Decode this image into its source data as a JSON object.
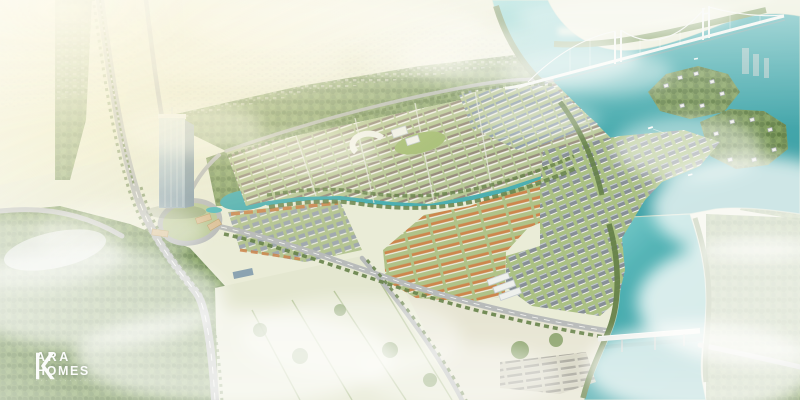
{
  "meta": {
    "title": "Aerial 3D master-plan rendering of a riverside township",
    "width": 800,
    "height": 400
  },
  "watermark": {
    "monogram": "K",
    "name_top": "ARA",
    "name_bottom": "HOMES",
    "tagline": "· · · · · · · · · · · · · ·"
  },
  "palette": {
    "land": "#e9ebd6",
    "field": "#e3e6cf",
    "lawn": "#b2c38f",
    "lawn2": "#a9bd7e",
    "forest": "#6d8d4b",
    "forest_dark": "#577539",
    "water": "#39a7ac",
    "water_deep": "#2c99a1",
    "water_light": "#7bd0d1",
    "shore": "#e9e4c9",
    "road": "#b2b5b6",
    "road_dash": "#ffffff",
    "roof_orange": "#c97a3d",
    "roof_brown": "#8d8172",
    "roof_blue": "#7e90a4",
    "roof_gray": "#7b848e",
    "wall": "#f4f3ec",
    "glass_light": "#cfe0ea",
    "glass_dark": "#8fa7b8",
    "glass_side": "#7d95a6",
    "bridge": "#f2f5f3",
    "cloud": "#ffffff",
    "glow": "#f9f0c8",
    "podium": "#d2a56a"
  },
  "scene": {
    "features": [
      "river",
      "canal",
      "suspension-bridge",
      "road-bridge",
      "high-rise-tower",
      "housing-grid",
      "villa-district",
      "island-villas",
      "orange-townhouses",
      "highway",
      "roundabout",
      "forest",
      "clouds"
    ]
  }
}
